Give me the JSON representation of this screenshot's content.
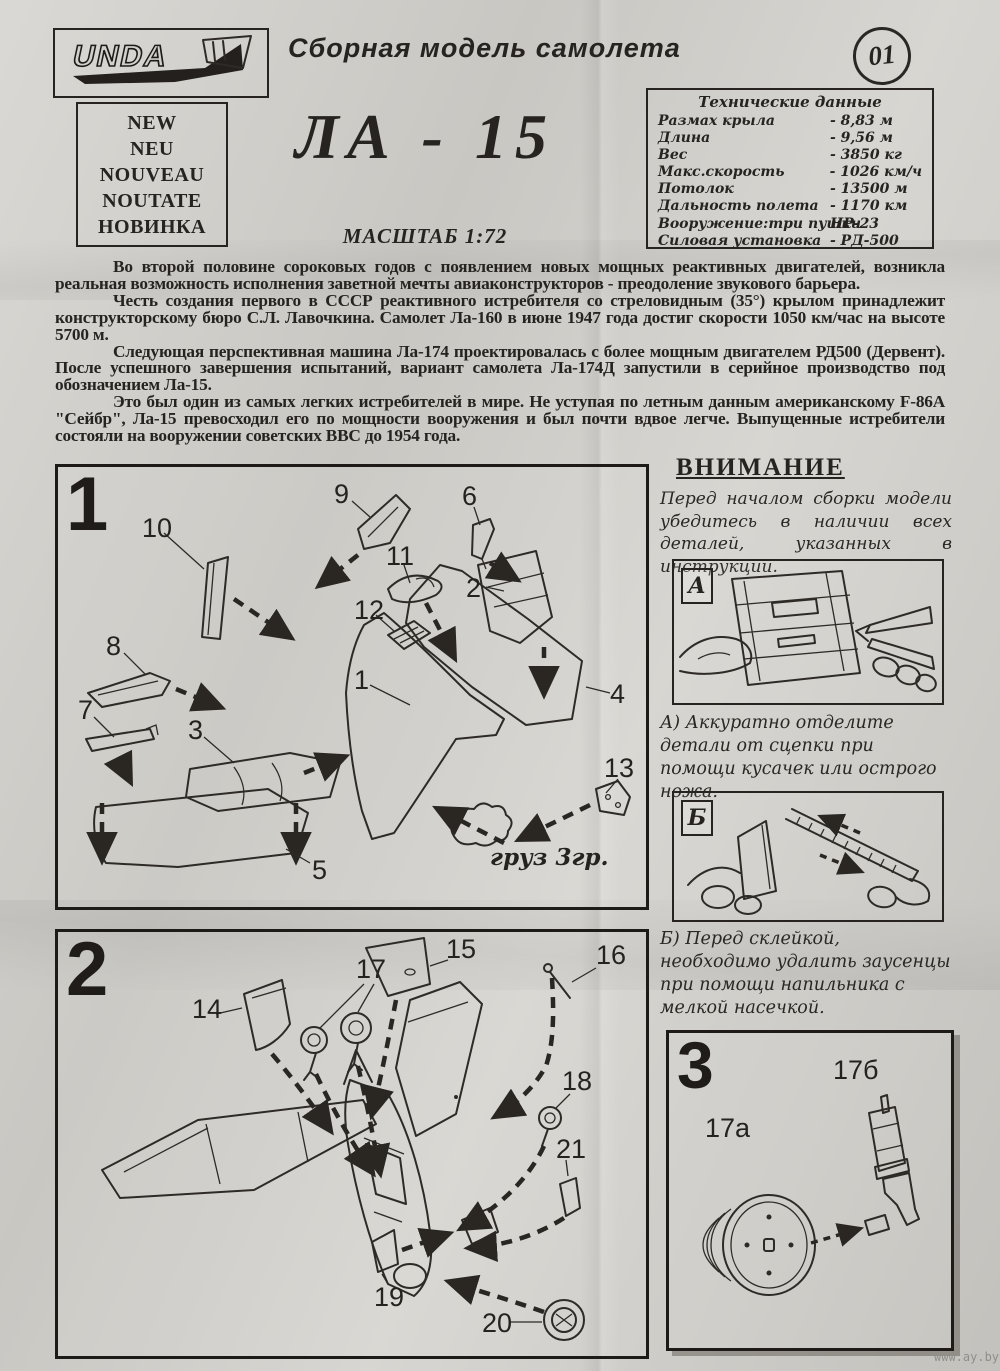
{
  "page": {
    "brand": "UNDA",
    "header_title": "Сборная модель самолета",
    "sheet_number": "01",
    "new_box_lines": [
      "NEW",
      "NEU",
      "NOUVEAU",
      "NOUTATE",
      "НОВИНКА"
    ],
    "model_title": "ЛА - 15",
    "scale": "МАСШТАБ 1:72",
    "paper_color": "#d2d0cb",
    "ink_color": "#262320"
  },
  "tech_specs": {
    "title": "Технические данные",
    "rows": [
      {
        "label": "Размах крыла",
        "value": "- 8,83 м"
      },
      {
        "label": "Длина",
        "value": "- 9,56 м"
      },
      {
        "label": "Вес",
        "value": "- 3850 кг"
      },
      {
        "label": "Макс.скорость",
        "value": "- 1026 км/ч"
      },
      {
        "label": "Потолок",
        "value": "- 13500 м"
      },
      {
        "label": "Дальность полета",
        "value": "- 1170 км"
      },
      {
        "label": "Вооружение:три пушки",
        "value": "НР-23"
      },
      {
        "label": "Силовая установка",
        "value": "- РД-500"
      }
    ]
  },
  "history": {
    "p1": "Во второй половине сороковых годов с появлением новых мощных реактивных двигателей, возникла реальная возможность исполнения заветной мечты авиаконструкторов - преодоление звукового барьера.",
    "p2": "Честь создания первого в СССР реактивного истребителя со стреловидным (35°) крылом принадлежит конструкторскому бюро С.Л. Лавочкина. Самолет Ла-160 в июне 1947 года достиг скорости 1050 км/час на высоте 5700 м.",
    "p3": "Следующая перспективная машина Ла-174 проектировалась с более мощным двигателем РД500 (Дервент). После успешного завершения испытаний, вариант самолета Ла-174Д запустили в серийное производство под обозначением Ла-15.",
    "p4": "Это был один из самых легких истребителей в мире. Не уступая по летным данным американскому F-86A \"Сейбр\", Ла-15 превосходил его по мощности вооружения и был почти вдвое легче. Выпущенные истребители состояли на вооружении советских ВВС до 1954 года."
  },
  "attention": {
    "title": "ВНИМАНИЕ",
    "text": "Перед началом сборки модели убедитесь в наличии всех деталей, указанных в инструкции.",
    "step_a_label": "А",
    "step_a_text": "А) Аккуратно отделите детали от сцепки при помощи кусачек или острого ножа.",
    "step_b_label": "Б",
    "step_b_text": "Б) Перед склейкой, необходимо удалить заусенцы при помощи напильника с мелкой насечкой."
  },
  "step1": {
    "number": "1",
    "weight_note": "груз 3гр.",
    "labels": [
      "1",
      "2",
      "3",
      "4",
      "5",
      "6",
      "7",
      "8",
      "9",
      "10",
      "11",
      "12",
      "13"
    ]
  },
  "step2": {
    "number": "2",
    "labels": [
      "14",
      "15",
      "16",
      "17",
      "18",
      "19",
      "20",
      "21"
    ]
  },
  "step3": {
    "number": "3",
    "label_a": "17а",
    "label_b": "17б"
  },
  "watermark": "www.ay.by"
}
